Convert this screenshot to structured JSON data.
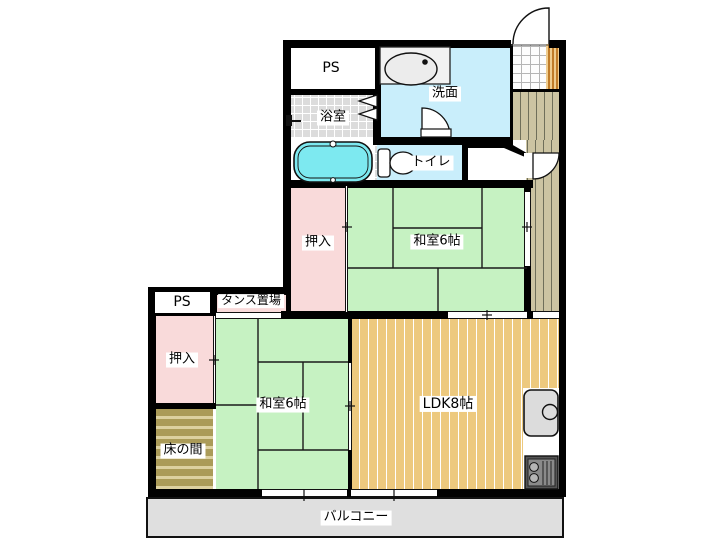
{
  "rooms": {
    "ps_top": {
      "label": "PS"
    },
    "bathroom": {
      "label": "浴室"
    },
    "washroom": {
      "label": "洗面"
    },
    "toilet": {
      "label": "トイレ"
    },
    "closet_top": {
      "label": "押入"
    },
    "washitsu_top": {
      "label": "和室6帖"
    },
    "ps_left": {
      "label": "PS"
    },
    "tansu": {
      "label": "タンス置場"
    },
    "closet_left": {
      "label": "押入"
    },
    "tokonoma": {
      "label": "床の間"
    },
    "washitsu_bottom": {
      "label": "和室6帖"
    },
    "ldk": {
      "label": "LDK8帖"
    },
    "balcony": {
      "label": "バルコニー"
    }
  },
  "icons": [
    "bathtub-icon",
    "washbasin-icon",
    "toilet-icon",
    "kitchen-sink-icon",
    "stove-icon",
    "shower-icon",
    "entry-door-icon",
    "washroom-door-icon",
    "hallway-door-icon",
    "folding-door-icon",
    "window-marker",
    "sliding-door-marker"
  ],
  "colors": {
    "wall": "#000000",
    "tatami_green": "#c6f2c2",
    "closet_pink": "#f9dada",
    "wet_area_cyan": "#c9eefb",
    "bathtub_cyan": "#7de9f0",
    "ldk_wood": "#edc97e",
    "hallway_wood": "#ccc4a2",
    "tokonoma_wood": "#ab9b58",
    "balcony_gray": "#dfdfdf",
    "bath_tile_gray": "#dcdcdc"
  }
}
